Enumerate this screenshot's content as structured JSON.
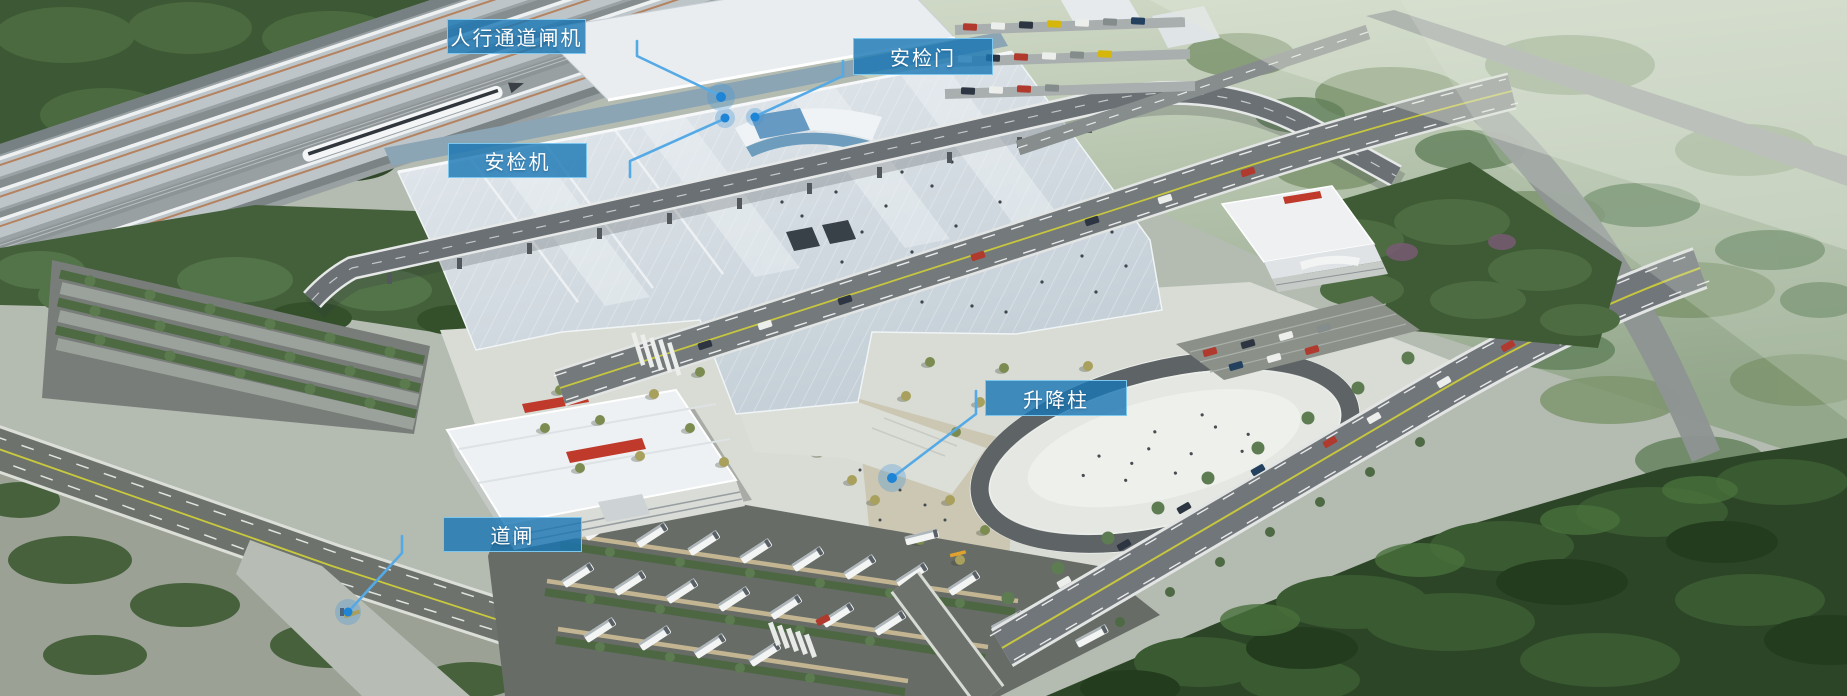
{
  "scene": {
    "type": "aerial-station-render",
    "accent_color": "#2a86c8",
    "label_fill": "rgba(24,118,180,0.8)",
    "label_border": "#7dc7ef",
    "leader_line_color": "#55aae6",
    "marker_color": "#1d84d6"
  },
  "callouts": [
    {
      "id": "pedestrian-gate",
      "label": "人行通道闸机"
    },
    {
      "id": "security-door",
      "label": "安检门"
    },
    {
      "id": "security-scanner",
      "label": "安检机"
    },
    {
      "id": "lifting-bollard",
      "label": "升降柱"
    },
    {
      "id": "barrier-gate",
      "label": "道闸"
    }
  ]
}
